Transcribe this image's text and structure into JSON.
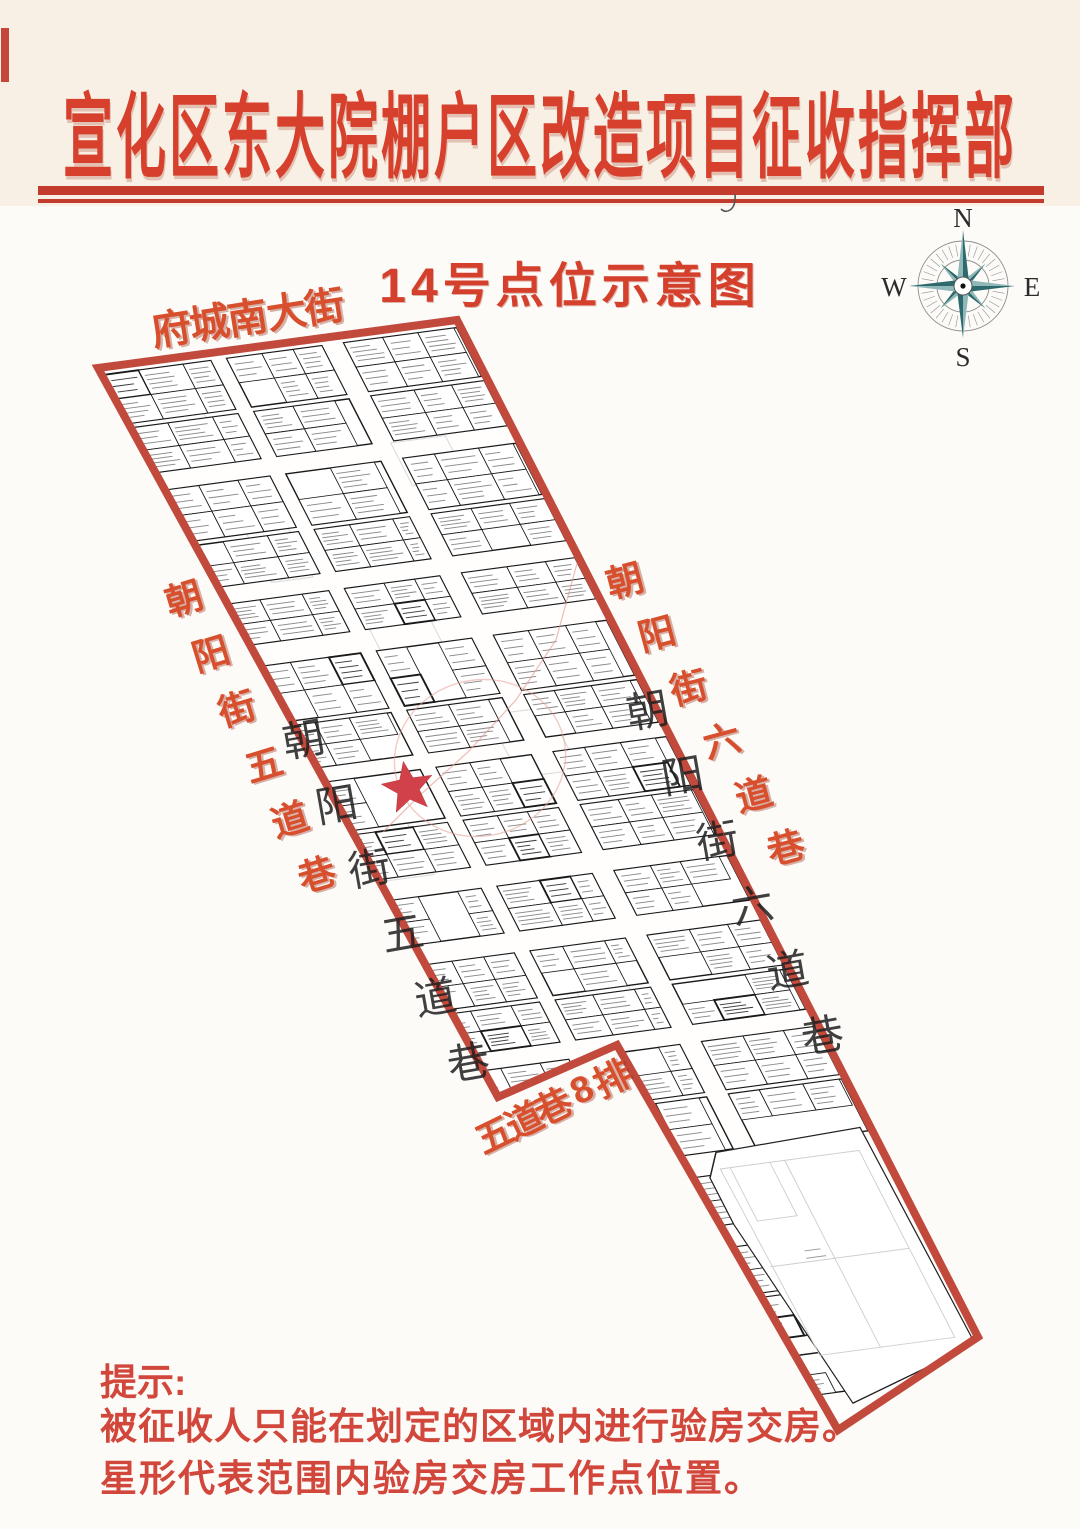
{
  "poster": {
    "title": "宣化区东大院棚户区改造项目征收指挥部",
    "subtitle": "14号点位示意图"
  },
  "compass": {
    "n": "N",
    "e": "E",
    "s": "S",
    "w": "W"
  },
  "map": {
    "street_top": "府城南大街",
    "street_left": "朝阳街五道巷",
    "street_right": "朝阳街六道巷",
    "street_bottom": "五道巷8排",
    "inner_street_left": "朝阳街五道巷",
    "inner_street_right": "朝阳街六道巷"
  },
  "hint": {
    "label": "提示:",
    "line1": "被征收人只能在划定的区域内进行验房交房。",
    "line2": "星形代表范围内验房交房工作点位置。"
  },
  "colors": {
    "title_red": "#d6402c",
    "border_red": "#c14a3d",
    "star_red": "#d0414a",
    "label_red": "#d84f2e",
    "compass_teal": "#2e6a6d"
  }
}
